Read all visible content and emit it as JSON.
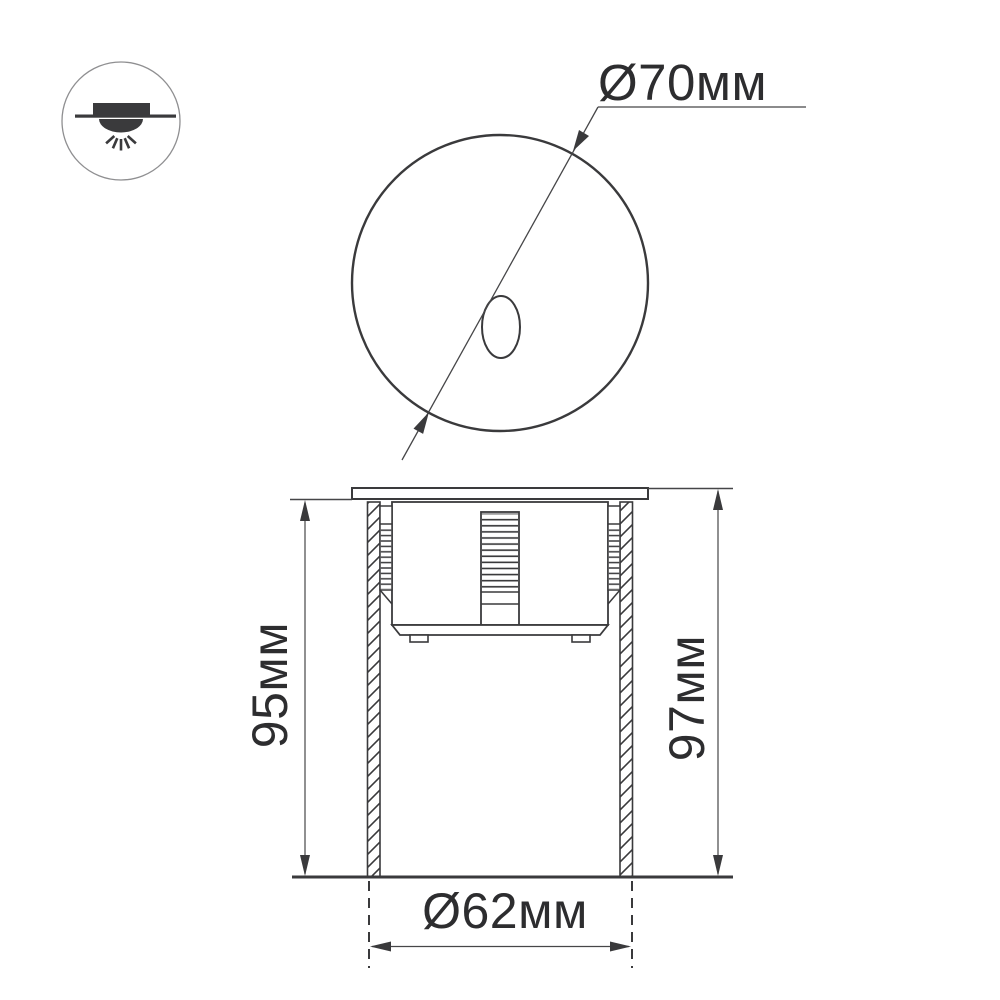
{
  "drawing": {
    "title": "recessed-luminaire-dimension-drawing",
    "views": {
      "front_view": "round face with oval lens aperture",
      "side_view": "recessed body with flange, hatched mounting sleeve and heatsink column"
    }
  },
  "dimensions": {
    "face_diameter": "Ø70мм",
    "recess_depth": "95мм",
    "overall_height": "97мм",
    "cutout_diameter": "Ø62мм"
  },
  "icon": {
    "name": "recessed-mount-downlight",
    "meaning": "luminaire is recessed into ceiling/wall surface"
  },
  "colors": {
    "background": "#ffffff",
    "line": "#3a3a3c",
    "dimension_line": "#464648",
    "text": "#2d2d2f",
    "icon_fill": "#3a3a3c",
    "icon_circle_outline": "#8f8f91"
  }
}
